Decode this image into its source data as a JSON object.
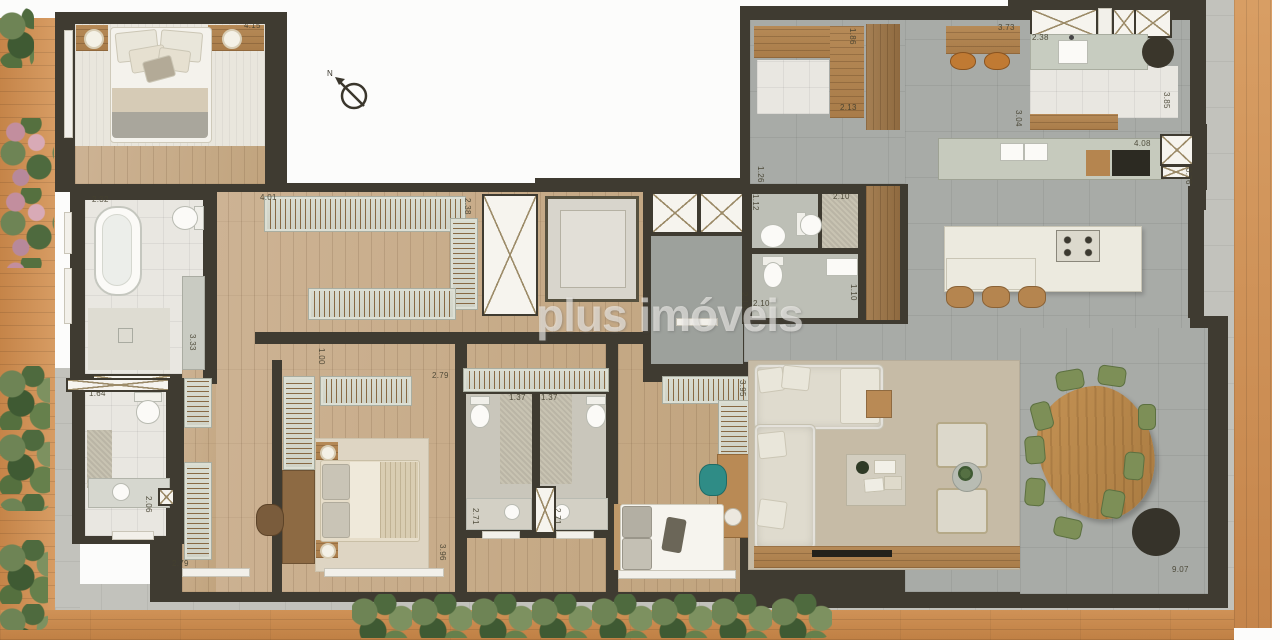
{
  "watermark": "plus imóveis",
  "compass": {
    "label": "N"
  },
  "dims": [
    {
      "t": "4.15",
      "x": 244,
      "y": 22,
      "v": false
    },
    {
      "t": "2.32",
      "x": 92,
      "y": 196,
      "v": false
    },
    {
      "t": "3.33",
      "x": 188,
      "y": 334,
      "v": true
    },
    {
      "t": "1.64",
      "x": 89,
      "y": 390,
      "v": false
    },
    {
      "t": "2.06",
      "x": 144,
      "y": 496,
      "v": true
    },
    {
      "t": "2.79",
      "x": 172,
      "y": 560,
      "v": false
    },
    {
      "t": "4.01",
      "x": 260,
      "y": 194,
      "v": false
    },
    {
      "t": "2.38",
      "x": 463,
      "y": 198,
      "v": true
    },
    {
      "t": "1.00",
      "x": 317,
      "y": 348,
      "v": true
    },
    {
      "t": "2.79",
      "x": 432,
      "y": 372,
      "v": false
    },
    {
      "t": "3.96",
      "x": 438,
      "y": 544,
      "v": true
    },
    {
      "t": "1.37",
      "x": 509,
      "y": 394,
      "v": false
    },
    {
      "t": "1.37",
      "x": 541,
      "y": 394,
      "v": false
    },
    {
      "t": "2.71",
      "x": 471,
      "y": 508,
      "v": true
    },
    {
      "t": "2.71",
      "x": 553,
      "y": 508,
      "v": true
    },
    {
      "t": "3.95",
      "x": 738,
      "y": 380,
      "v": true
    },
    {
      "t": "2.10",
      "x": 833,
      "y": 193,
      "v": false
    },
    {
      "t": "1.12",
      "x": 751,
      "y": 194,
      "v": true
    },
    {
      "t": "2.10",
      "x": 753,
      "y": 300,
      "v": false
    },
    {
      "t": "1.10",
      "x": 849,
      "y": 284,
      "v": true
    },
    {
      "t": "2.10",
      "x": 740,
      "y": 292,
      "v": true
    },
    {
      "t": "2.13",
      "x": 840,
      "y": 104,
      "v": false
    },
    {
      "t": "1.86",
      "x": 848,
      "y": 28,
      "v": true
    },
    {
      "t": "1.26",
      "x": 756,
      "y": 166,
      "v": true
    },
    {
      "t": "3.73",
      "x": 998,
      "y": 24,
      "v": false
    },
    {
      "t": "2.38",
      "x": 1032,
      "y": 34,
      "v": false
    },
    {
      "t": "3.85",
      "x": 1162,
      "y": 92,
      "v": true
    },
    {
      "t": "3.04",
      "x": 1014,
      "y": 110,
      "v": true
    },
    {
      "t": "4.08",
      "x": 1134,
      "y": 140,
      "v": false
    },
    {
      "t": "0.76",
      "x": 1184,
      "y": 168,
      "v": true
    },
    {
      "t": "9.07",
      "x": 1172,
      "y": 566,
      "v": false
    }
  ],
  "colors": {
    "wall": "#3f3b31",
    "wood_floor": "#c7ae8c",
    "deck_wood": "#c9935c",
    "tile_white": "#e8e6e0",
    "tile_grey": "#a8aba7",
    "rug": "#c6bba6",
    "teal_chair": "#2f8c86",
    "dining_chair_green": "#7d8f57",
    "stool_orange": "#c07a33",
    "table_wood": "#bf8f52"
  }
}
